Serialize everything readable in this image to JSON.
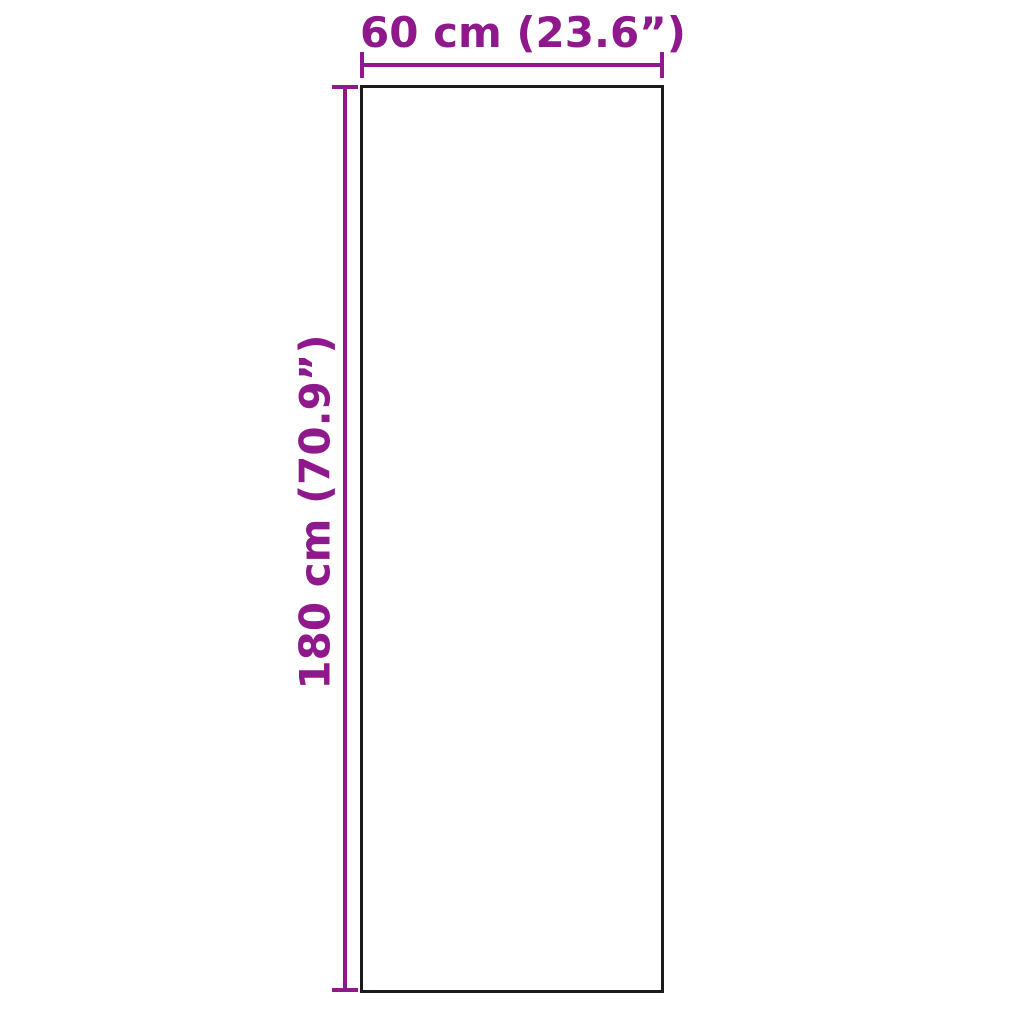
{
  "diagram": {
    "type": "product-dimension-diagram",
    "width_label": "60 cm (23.6”)",
    "height_label": "180 cm (70.9”)",
    "width": {
      "cm": 60,
      "inches": 23.6
    },
    "height": {
      "cm": 180,
      "inches": 70.9
    },
    "colors": {
      "accent": "#8E188C",
      "outline": "#1B1B1B",
      "background": "#FFFFFF"
    }
  }
}
